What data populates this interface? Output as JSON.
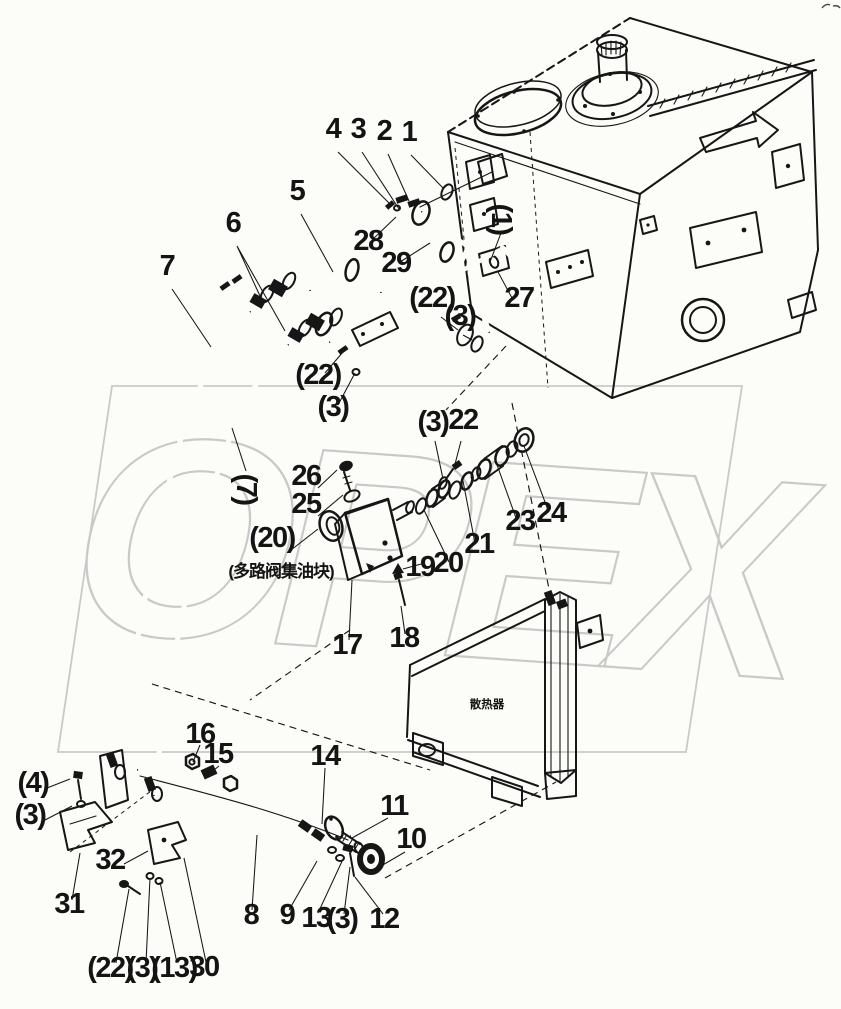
{
  "figure": {
    "type": "exploded-parts-diagram",
    "watermark": "OPEX",
    "notes": {
      "valve_block": "(多路阀集油块)",
      "radiator": "散热器"
    },
    "callouts": [
      {
        "text": "4"
      },
      {
        "text": "3"
      },
      {
        "text": "2"
      },
      {
        "text": "1"
      },
      {
        "text": "5"
      },
      {
        "text": "6"
      },
      {
        "text": "7"
      },
      {
        "text": "28"
      },
      {
        "text": "29"
      },
      {
        "text": "27"
      },
      {
        "text": "(1)"
      },
      {
        "text": "(22)"
      },
      {
        "text": "(3)"
      },
      {
        "text": "(22)"
      },
      {
        "text": "(3)"
      },
      {
        "text": "(7)"
      },
      {
        "text": "(3)"
      },
      {
        "text": "22"
      },
      {
        "text": "26"
      },
      {
        "text": "25"
      },
      {
        "text": "(20)"
      },
      {
        "text": "19"
      },
      {
        "text": "20"
      },
      {
        "text": "21"
      },
      {
        "text": "23"
      },
      {
        "text": "24"
      },
      {
        "text": "17"
      },
      {
        "text": "18"
      },
      {
        "text": "16"
      },
      {
        "text": "15"
      },
      {
        "text": "14"
      },
      {
        "text": "(4)"
      },
      {
        "text": "(3)"
      },
      {
        "text": "31"
      },
      {
        "text": "32"
      },
      {
        "text": "(22)"
      },
      {
        "text": "(3)"
      },
      {
        "text": "(13)"
      },
      {
        "text": "30"
      },
      {
        "text": "8"
      },
      {
        "text": "9"
      },
      {
        "text": "13"
      },
      {
        "text": "(3)"
      },
      {
        "text": "12"
      },
      {
        "text": "11"
      },
      {
        "text": "10"
      }
    ]
  }
}
